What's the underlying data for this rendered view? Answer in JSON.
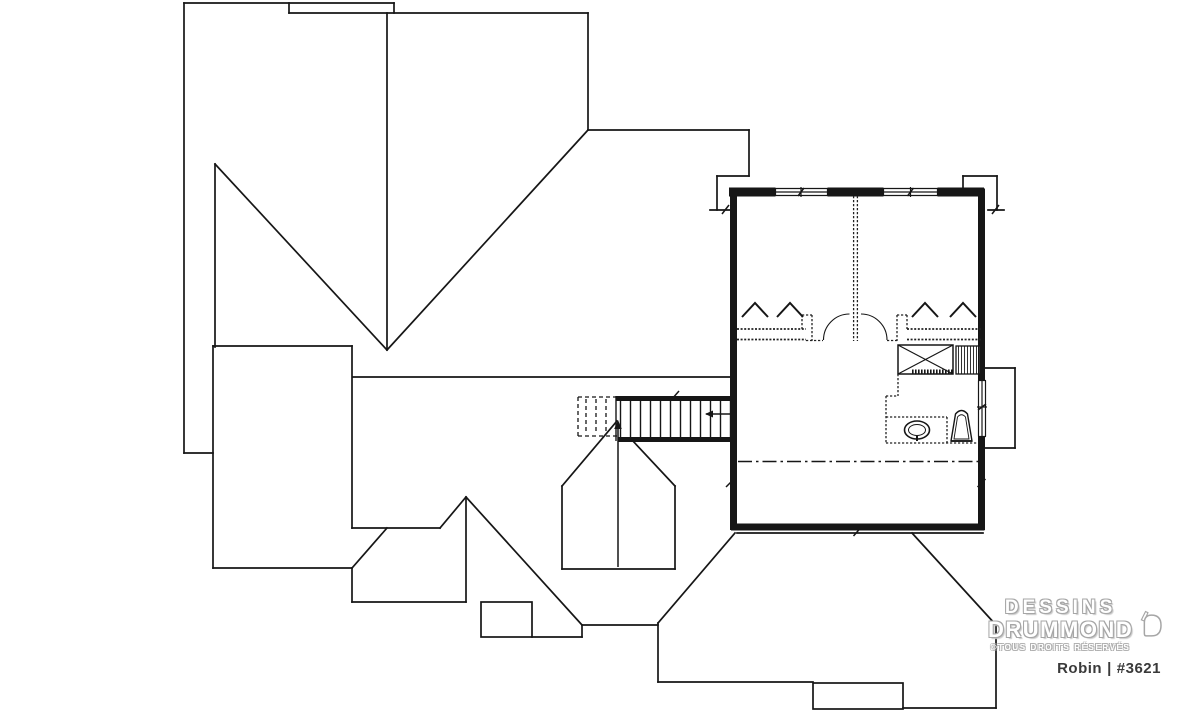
{
  "branding": {
    "name_line1": "DESSINS",
    "name_line2": "DRUMMOND",
    "rights_notice": "©TOUS DROITS RÉSERVÉS",
    "plan_name": "Robin",
    "divider": "|",
    "plan_number": "#3621"
  },
  "colors": {
    "background": "#ffffff",
    "line": "#161616",
    "wall_bold": "#161616",
    "logo_outline": "#a6a6a6",
    "plan_text": "#3a3a3a"
  }
}
